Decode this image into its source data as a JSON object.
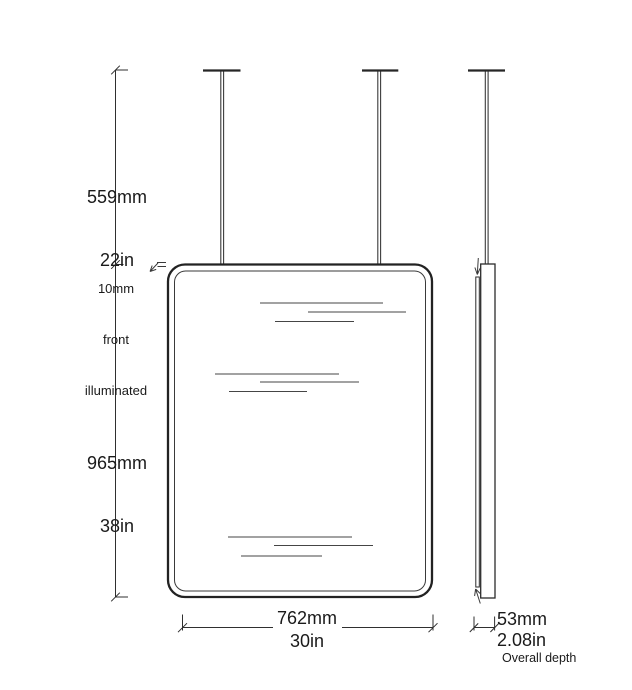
{
  "drawing_type": "mirror-dimension-diagram",
  "colors": {
    "background": "#ffffff",
    "line": "#2b2b2b",
    "rod": "#3a3a3a",
    "reflection": "#454545",
    "text": "#1a1a1a"
  },
  "dimensions": {
    "rod_drop": {
      "metric": "559mm",
      "imperial": "22in"
    },
    "mirror_height": {
      "metric": "965mm",
      "imperial": "38in"
    },
    "mirror_width": {
      "metric": "762mm",
      "imperial": "30in"
    },
    "depth": {
      "metric": "53mm",
      "imperial": "2.08in",
      "note": "Overall depth"
    },
    "front_note": {
      "line1": "10mm",
      "line2": "front",
      "line3": "illuminated"
    }
  }
}
